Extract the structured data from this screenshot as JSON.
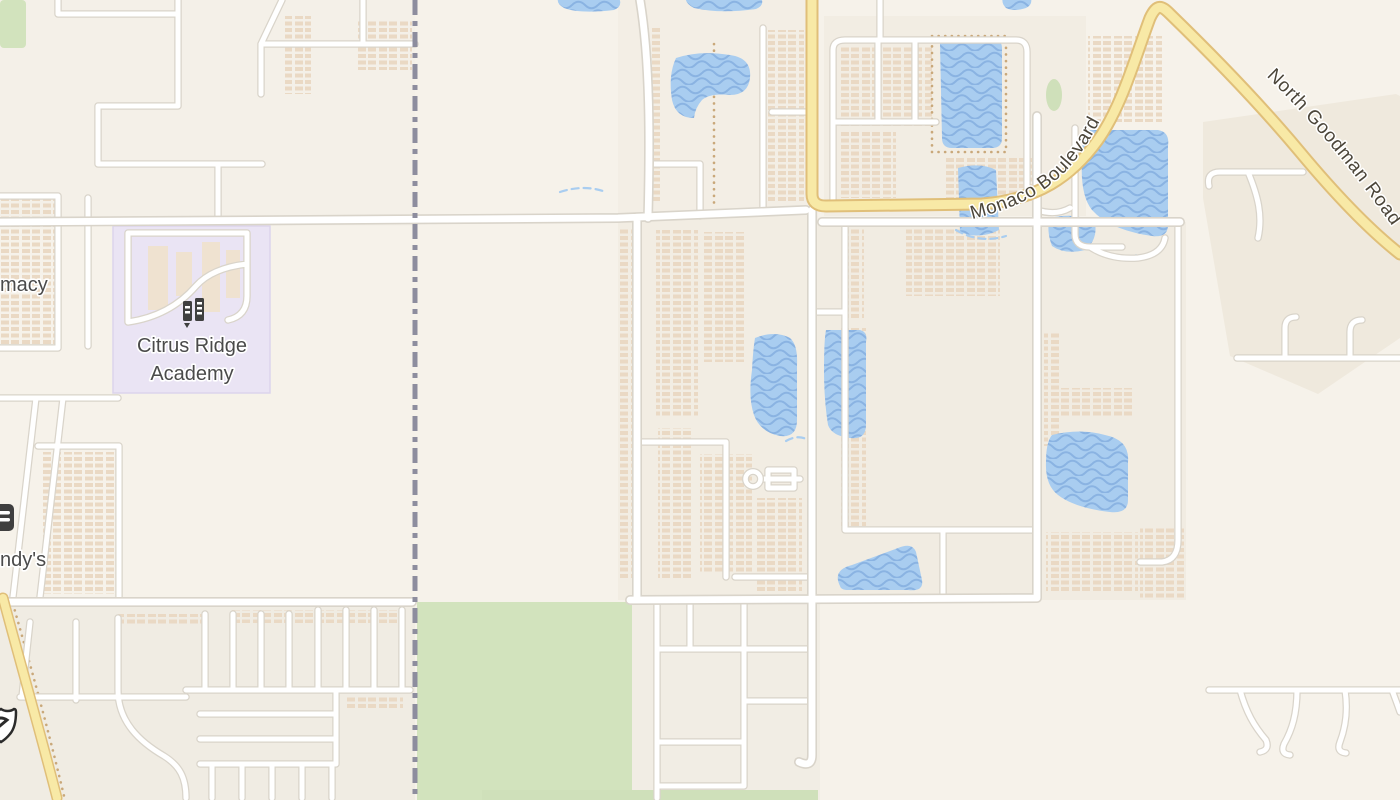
{
  "map": {
    "labels": {
      "academy_line1": "Citrus Ridge",
      "academy_line2": "Academy",
      "pharmacy_partial": "macy",
      "wendys_partial": "ndy's"
    },
    "road_labels": {
      "monaco": "Monaco Boulevard",
      "goodman": "North Goodman Road"
    },
    "icons": {
      "school": "school-icon",
      "fast_food": "fast-food-icon",
      "highway_shield": "highway-shield-icon"
    },
    "colors": {
      "background": "#f6f2ea",
      "water": "#a9cdf0",
      "water_wave": "#8ab3e2",
      "road_fill": "#ffffff",
      "road_casing": "#d9d4ca",
      "highway_fill": "#f8e9a6",
      "highway_casing": "#e0bf79",
      "school_area": "#eae4f4",
      "greenspace": "#d2e3bd",
      "residential": "#f1ece2",
      "building": "#ead9c4",
      "boundary": "#8d8d9e"
    }
  }
}
